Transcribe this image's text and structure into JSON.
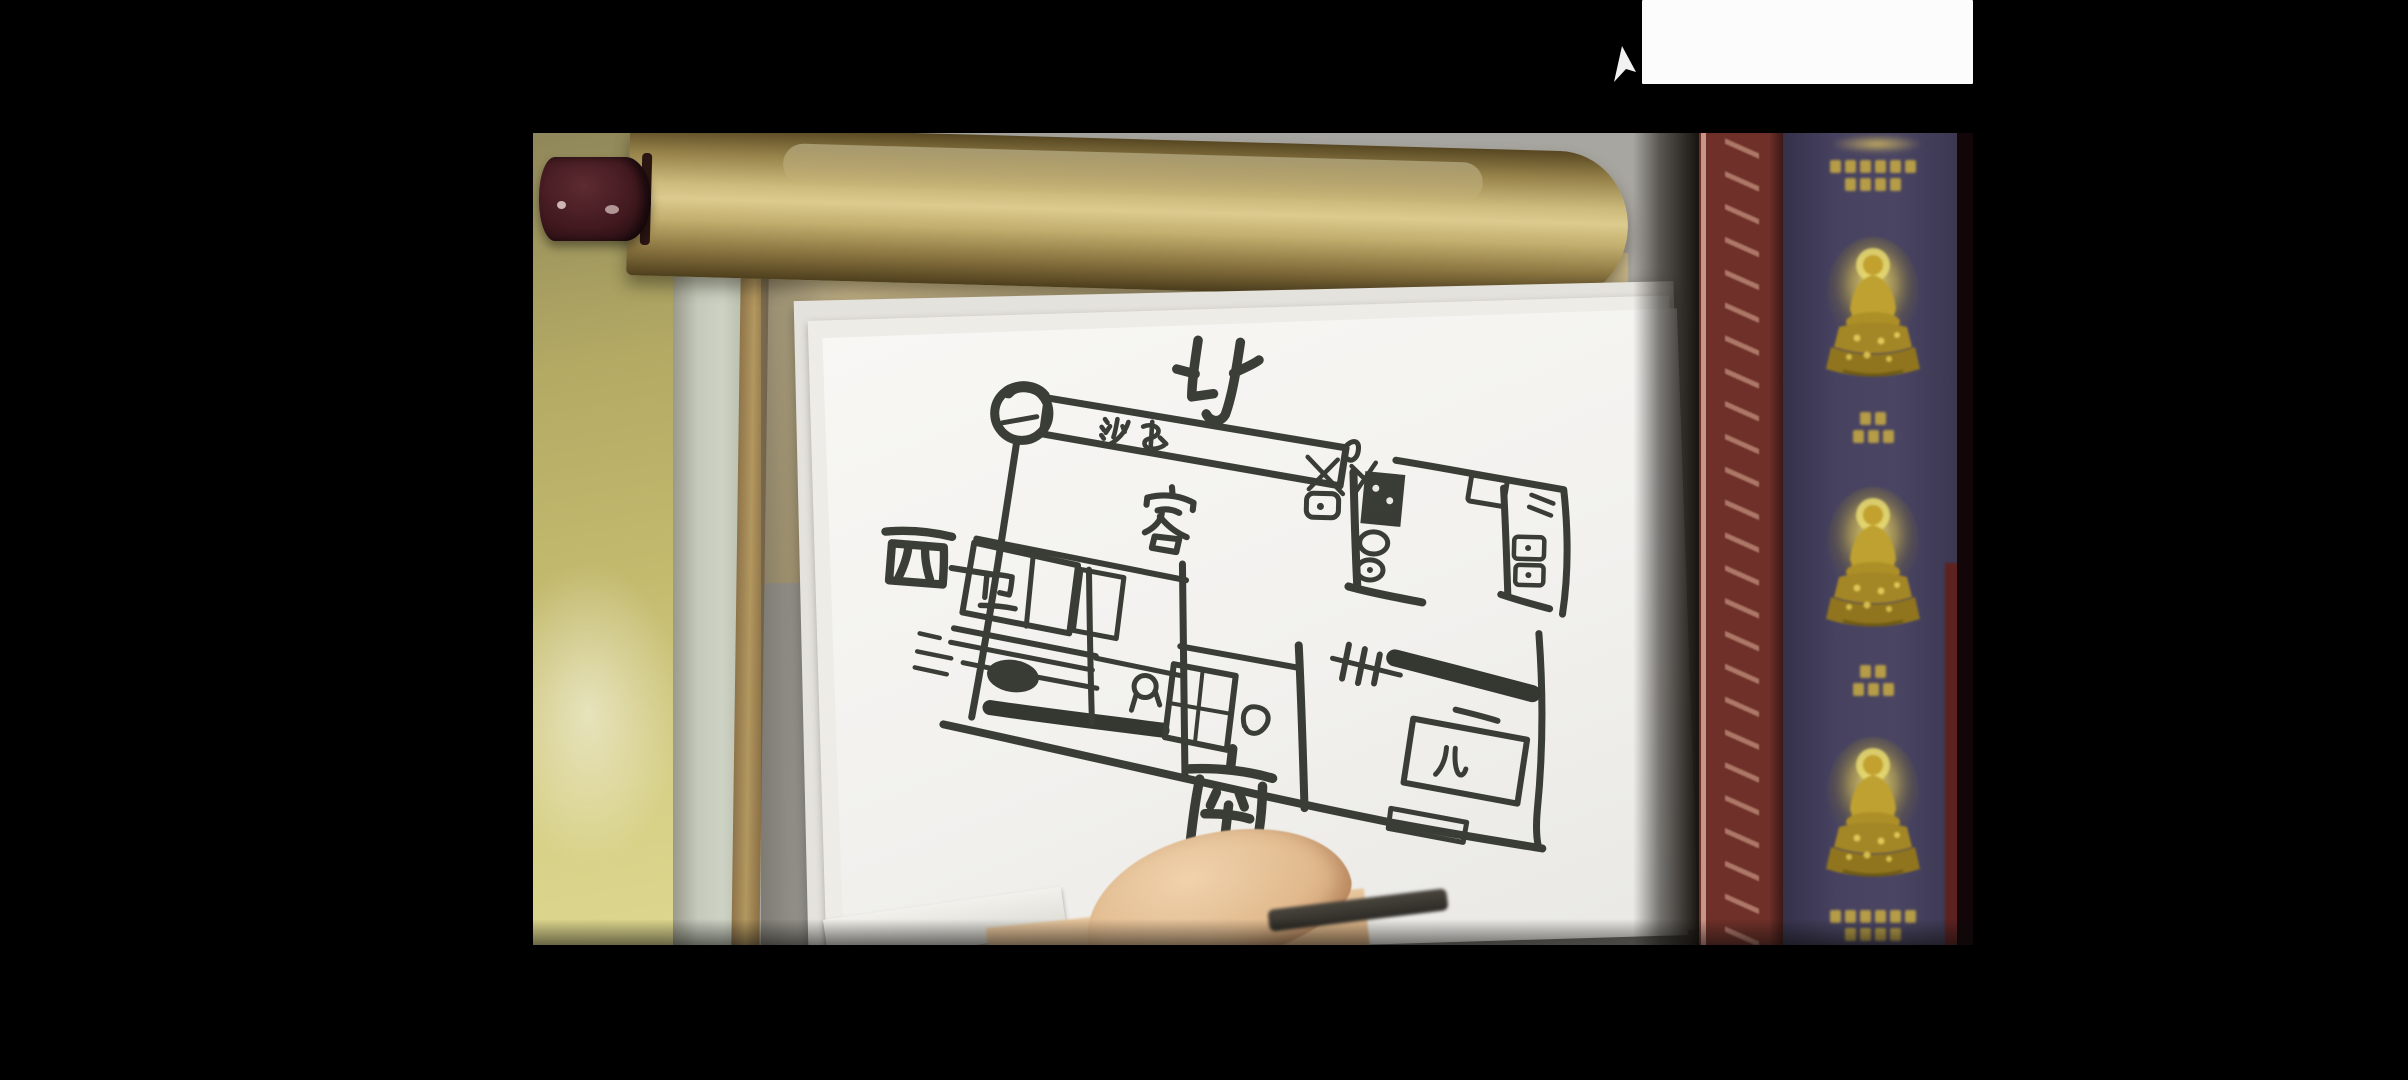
{
  "scene": {
    "type": "video still",
    "description": "A hand holds up a black-marker hand-drawn apartment floor plan on white paper in front of a gold hanging-scroll roller; to the right hangs a purple Buddhist banner with three glowing golden Buddha figures and a red ornamental border."
  },
  "floor_plan": {
    "compass": {
      "north": "北",
      "west": "西",
      "south": "南"
    },
    "labels": {
      "sofa": "沙发",
      "living_room": "客",
      "bathroom": "卫",
      "kids_room": "儿"
    }
  },
  "banner": {
    "buddha_count": 3,
    "text_legible": false,
    "text_blocks": [
      {
        "rows": [
          6,
          4
        ]
      },
      {
        "rows": [
          2,
          3
        ]
      },
      {
        "rows": [
          2,
          3
        ]
      },
      {
        "rows": [
          6,
          4
        ]
      }
    ]
  },
  "colors": {
    "background": "#000000",
    "wall_left": "#b9ae68",
    "scroll_roll": "#cdbb7d",
    "scroll_cap": "#41191f",
    "paper": "#f6f5f1",
    "ink": "#2d3029",
    "banner_red": "#6e3029",
    "banner_purple": "#474260",
    "buddha_gold": "#c9ae3f",
    "skin": "#e2bb8f",
    "overlay_box": "#fcfcfc"
  }
}
